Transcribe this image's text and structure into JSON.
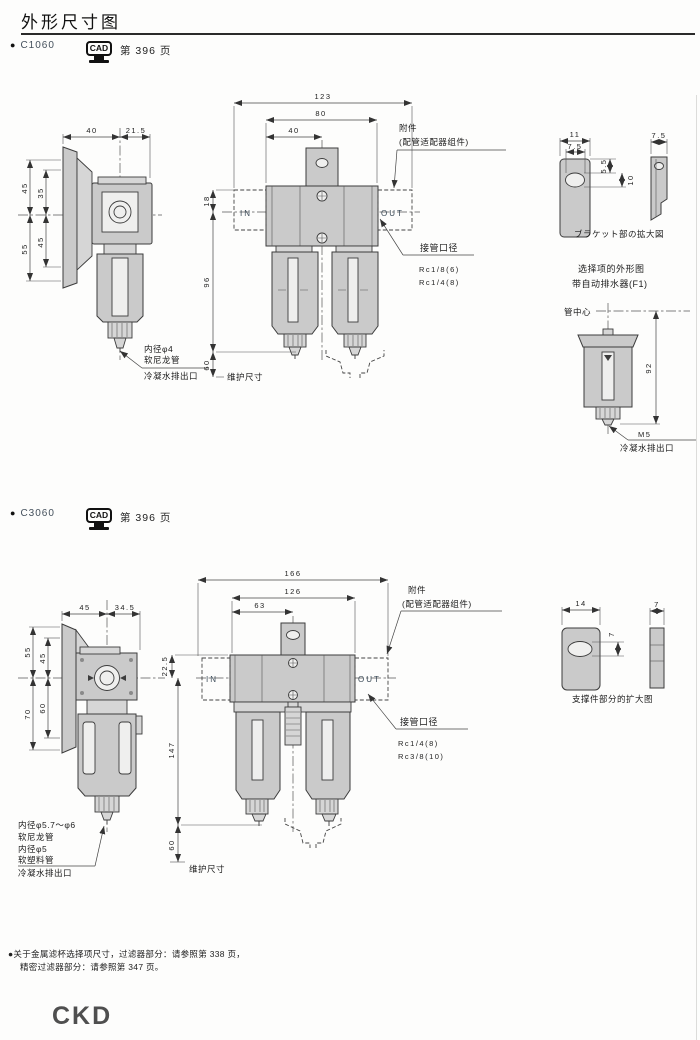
{
  "page": {
    "title": "外形尺寸图",
    "footer": {
      "note_line1": "●关于金属滤杯选择项尺寸，过滤器部分：请参照第 338 页，",
      "note_line2": "精密过滤器部分：请参照第 347 页。",
      "logo": "CKD"
    }
  },
  "sections": [
    {
      "bullet": "●",
      "model": "C1060",
      "cad_label": "CAD",
      "page_ref": "第 396 页",
      "side_view": {
        "dims": {
          "top1": "40",
          "top2": "21.5",
          "left_outer_top": "45",
          "left_inner_top": "35",
          "left_inner_bottom": "45",
          "left_outer_bottom": "55"
        },
        "notes": [
          "内径φ4",
          "软尼龙管",
          "冷凝水排出口"
        ]
      },
      "front_view": {
        "dims": {
          "width_total": "123",
          "width_body": "80",
          "width_half": "40",
          "h_top": "18",
          "h_body": "96",
          "h_maint": "60"
        },
        "in_label": "IN",
        "out_label": "OUT",
        "accessory_line1": "附件",
        "accessory_line2": "(配管适配器组件)",
        "port_title": "接管口径",
        "port_sizes": [
          "Rc1/8(6)",
          "Rc1/4(8)"
        ],
        "maintenance_label": "维护尺寸"
      },
      "bracket_detail": {
        "dims": {
          "w": "11",
          "w_inner": "7.5",
          "h1": "5.5",
          "h2": "10",
          "side_w": "7.5"
        },
        "caption": "ブラケット部の拡大図"
      },
      "option_view": {
        "title_line1": "选择项的外形图",
        "title_line2": "带自动排水器(F1)",
        "pipe_center_label": "管中心",
        "dim_height": "92",
        "thread_label": "M5",
        "drain_label": "冷凝水排出口"
      }
    },
    {
      "bullet": "●",
      "model": "C3060",
      "cad_label": "CAD",
      "page_ref": "第 396 页",
      "side_view": {
        "dims": {
          "top1": "45",
          "top2": "34.5",
          "left_outer_top": "55",
          "left_inner_top": "45",
          "left_inner_bottom": "60",
          "left_outer_bottom": "70"
        },
        "notes": [
          "内径φ5.7～φ6",
          "软尼龙管",
          "内径φ5",
          "软塑料管",
          "冷凝水排出口"
        ]
      },
      "front_view": {
        "dims": {
          "width_total": "166",
          "width_body": "126",
          "width_half": "63",
          "h_top": "22.5",
          "h_body": "147",
          "h_maint": "60"
        },
        "in_label": "IN",
        "out_label": "OUT",
        "accessory_line1": "附件",
        "accessory_line2": "(配管适配器组件)",
        "port_title": "接管口径",
        "port_sizes": [
          "Rc1/4(8)",
          "Rc3/8(10)"
        ],
        "maintenance_label": "维护尺寸"
      },
      "bracket_detail": {
        "dims": {
          "w": "14",
          "hole_h": "7",
          "side_w": "7"
        },
        "caption": "支撑件部分的扩大图"
      }
    }
  ]
}
